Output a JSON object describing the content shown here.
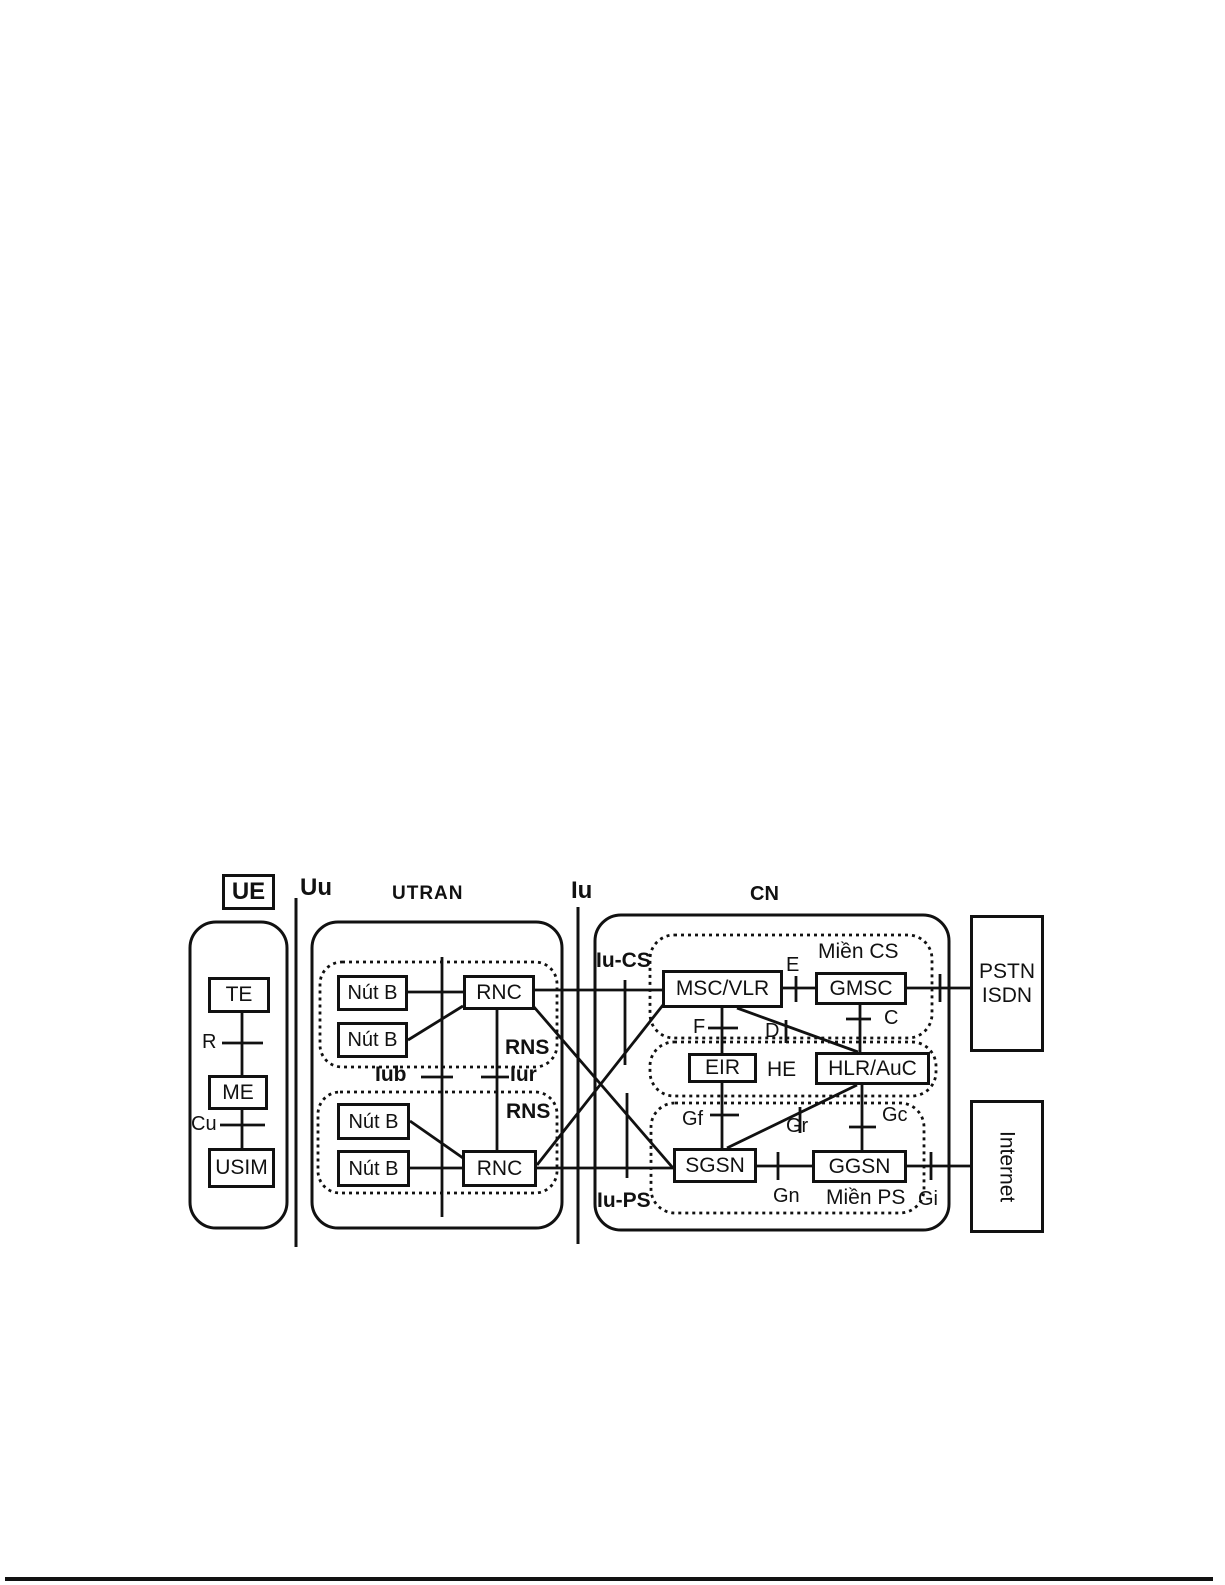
{
  "labels": {
    "ue_box": "UE",
    "uu": "Uu",
    "utran": "UTRAN",
    "iu": "Iu",
    "cn": "CN"
  },
  "ue": {
    "te": "TE",
    "if_r": "R",
    "me": "ME",
    "if_cu": "Cu",
    "usim": "USIM"
  },
  "utran": {
    "rns_top": {
      "label": "RNS",
      "node_b_1": "Nút B",
      "node_b_2": "Nút B",
      "rnc": "RNC"
    },
    "rns_bottom": {
      "label": "RNS",
      "node_b_1": "Nút B",
      "node_b_2": "Nút B",
      "rnc": "RNC"
    },
    "if_iub": "Iub",
    "if_iur": "Iur"
  },
  "cn": {
    "if_iu_cs": "Iu-CS",
    "if_iu_ps": "Iu-PS",
    "cs_domain": {
      "label": "Miền CS",
      "msc_vlr": "MSC/VLR",
      "gmsc": "GMSC",
      "if_e": "E",
      "if_c": "C",
      "if_d": "D",
      "if_f": "F"
    },
    "he": {
      "label": "HE",
      "eir": "EIR",
      "hlr_auc": "HLR/AuC"
    },
    "ps_domain": {
      "label": "Miền PS",
      "sgsn": "SGSN",
      "ggsn": "GGSN",
      "if_gf": "Gf",
      "if_gr": "Gr",
      "if_gc": "Gc",
      "if_gn": "Gn",
      "if_gi": "Gi"
    }
  },
  "external": {
    "pstn_line1": "PSTN",
    "pstn_line2": "ISDN",
    "internet": "Internet"
  }
}
